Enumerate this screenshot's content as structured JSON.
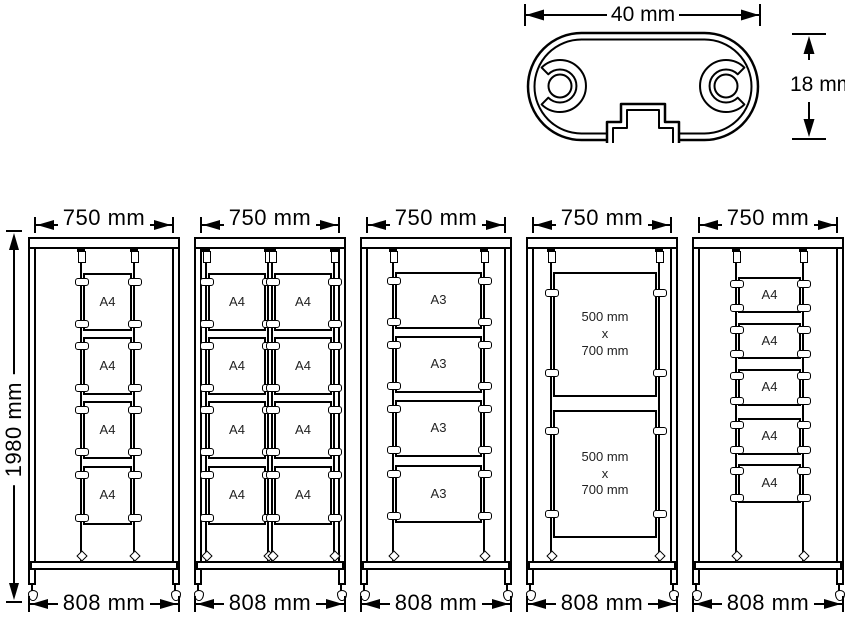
{
  "colors": {
    "line": "#000000",
    "background": "#ffffff"
  },
  "cross_section": {
    "width_label": "40 mm",
    "height_label": "18 mm"
  },
  "frame_height_label": "1980 mm",
  "stands": [
    {
      "top_width_label": "750 mm",
      "base_width_label": "808 mm",
      "panels": [
        "A4",
        "A4",
        "A4",
        "A4"
      ]
    },
    {
      "top_width_label": "750 mm",
      "base_width_label": "808 mm",
      "panels": [
        "A4",
        "A4",
        "A4",
        "A4",
        "A4",
        "A4",
        "A4",
        "A4"
      ]
    },
    {
      "top_width_label": "750 mm",
      "base_width_label": "808 mm",
      "panels": [
        "A3",
        "A3",
        "A3",
        "A3"
      ]
    },
    {
      "top_width_label": "750 mm",
      "base_width_label": "808 mm",
      "panels": [
        "500 mm\nx\n700 mm",
        "500 mm\nx\n700 mm"
      ]
    },
    {
      "top_width_label": "750 mm",
      "base_width_label": "808 mm",
      "panels": [
        "A4",
        "A4",
        "A4",
        "A4",
        "A4"
      ]
    }
  ]
}
